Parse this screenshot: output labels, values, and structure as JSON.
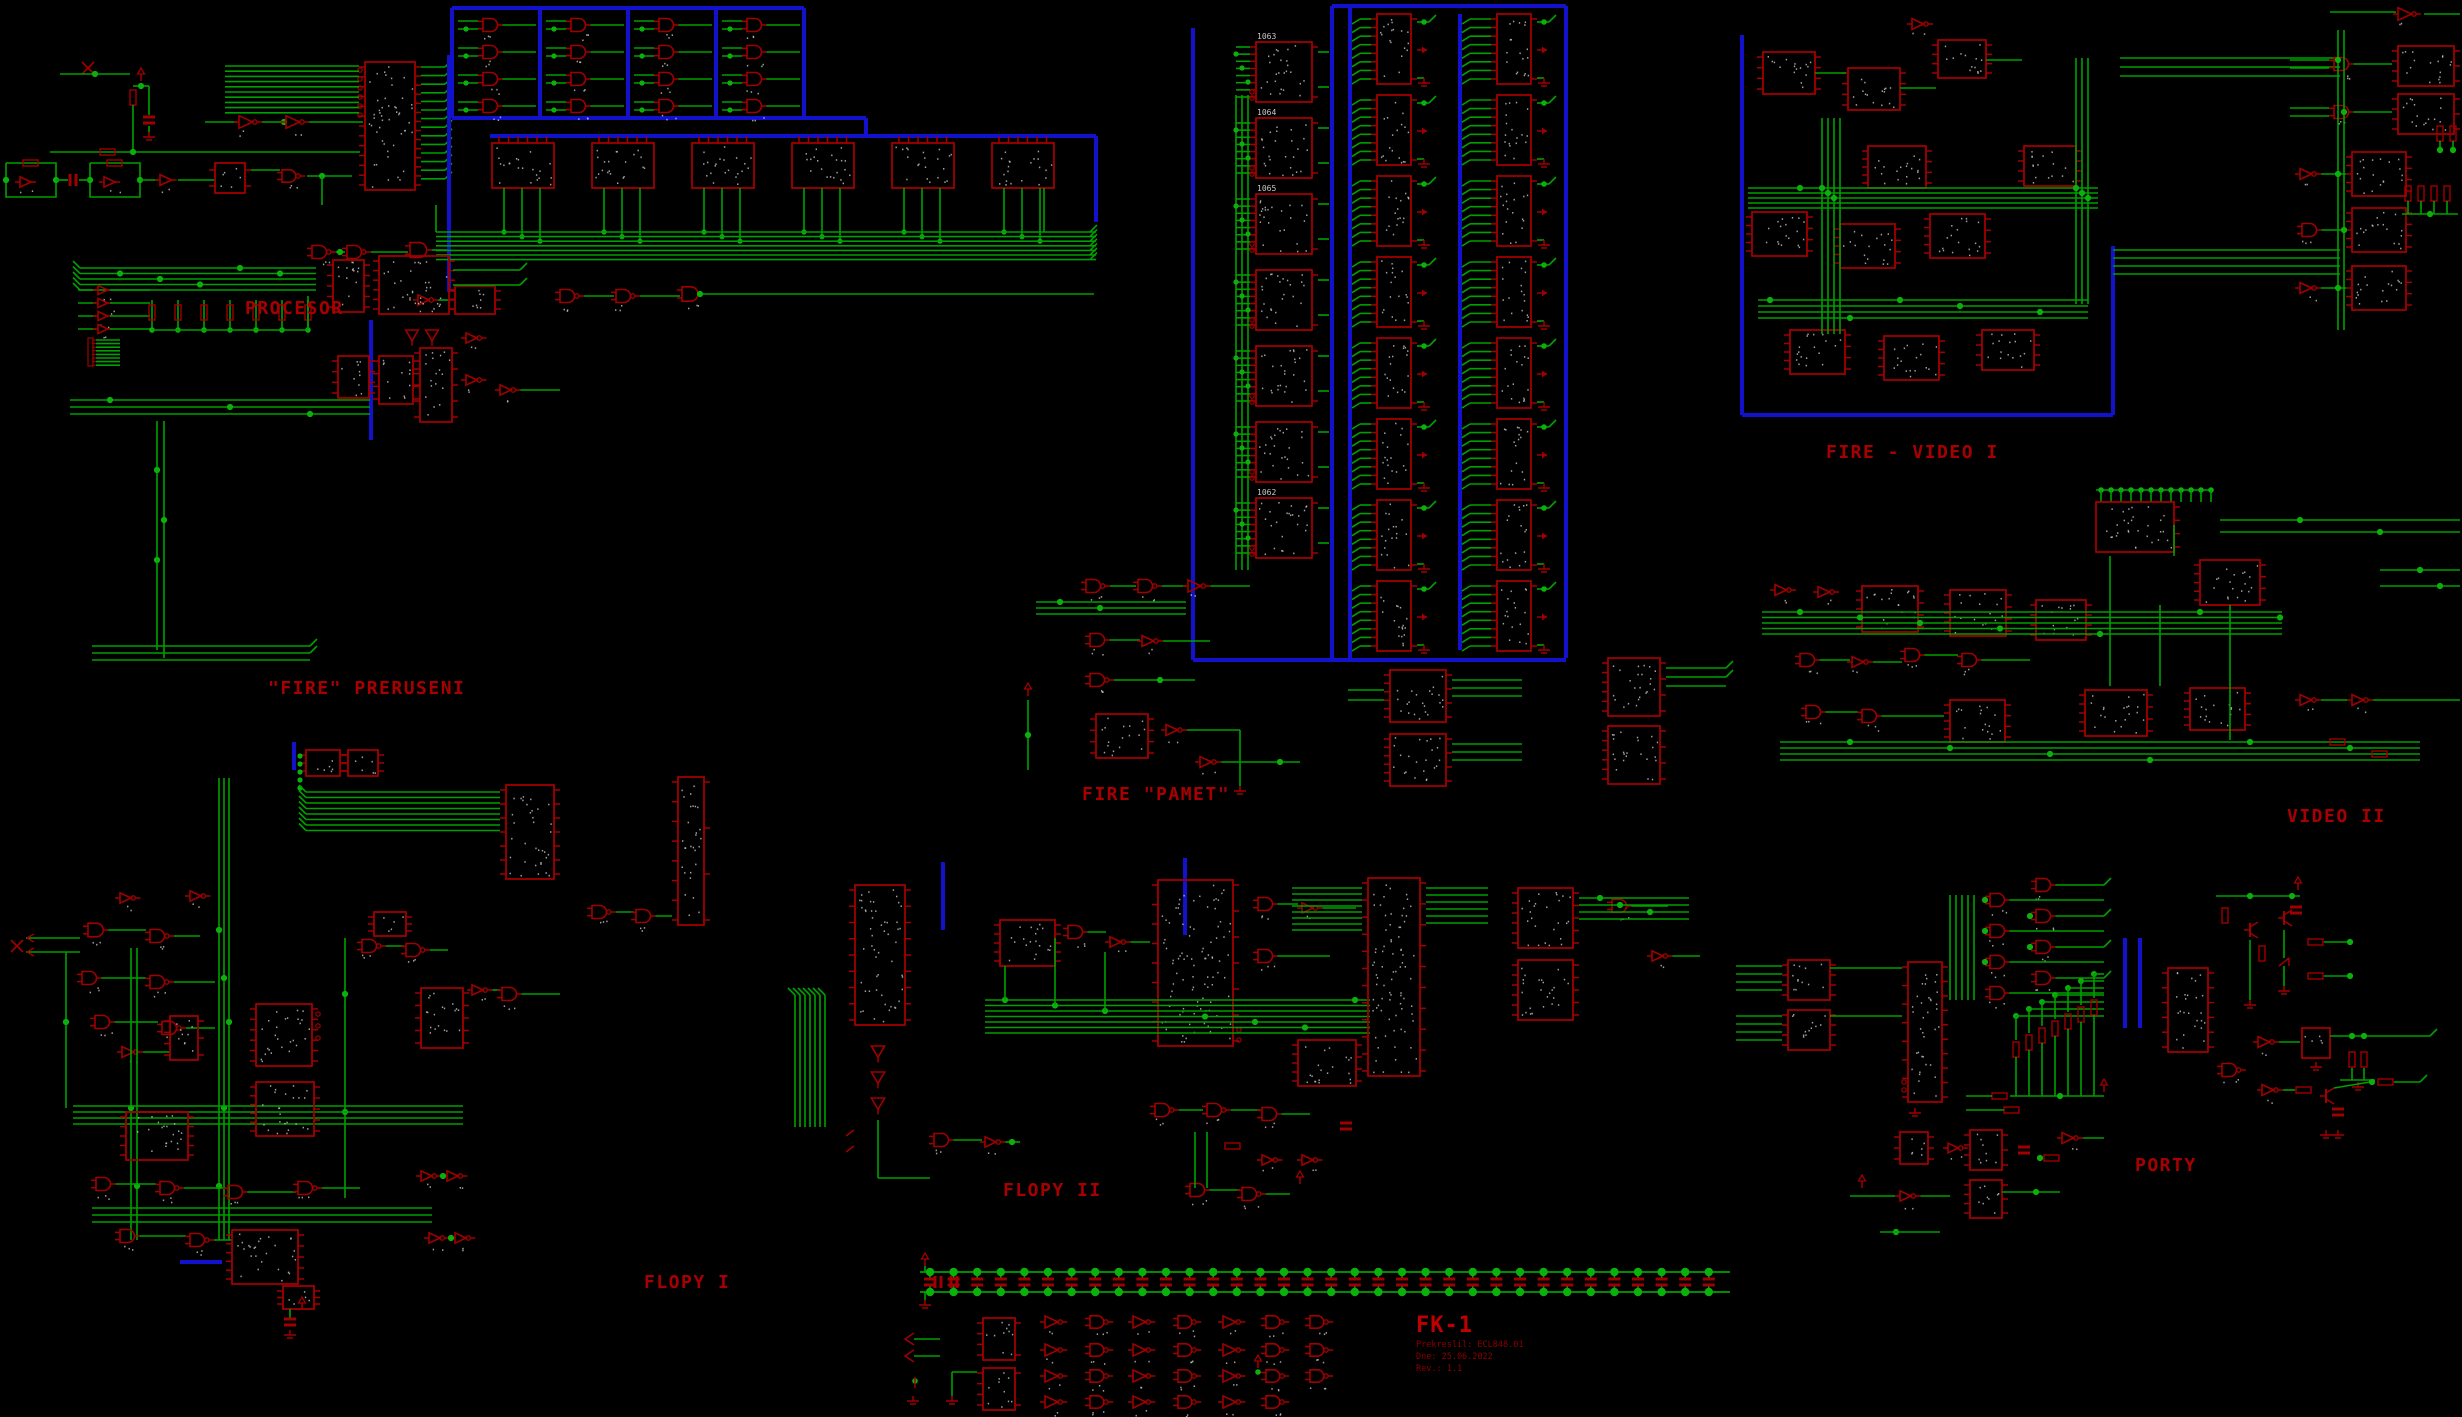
{
  "app": {
    "type": "schematic-drawing",
    "background": "#000000"
  },
  "colors": {
    "background": "#000000",
    "wire": "#00A000",
    "junction": "#0CB00C",
    "component": "#A00000",
    "bus": "#1212CC",
    "pin_text": "#C8C8C8",
    "label": "#A80000",
    "title": "#C00000",
    "title_dim": "#8C0000"
  },
  "sections": {
    "procesor": {
      "label": "PROCESOR"
    },
    "fire_preruseni": {
      "label": "\"FIRE\" PRERUSENI"
    },
    "fire_pamet": {
      "label": "FIRE \"PAMET\"",
      "ic_refs": [
        "1063",
        "1064",
        "1065",
        "1062"
      ]
    },
    "fire_video_i": {
      "label": "FIRE - VIDEO I"
    },
    "video_ii": {
      "label": "VIDEO II"
    },
    "flopy_i": {
      "label": "FLOPY I"
    },
    "flopy_ii": {
      "label": "FLOPY II"
    },
    "porty": {
      "label": "PORTY"
    }
  },
  "title_block": {
    "title": "FK-1",
    "line1": "Prekreslil: ECL848.01",
    "line2": "Dne: 25.06.2022",
    "line3": "Rev.: 1.1"
  }
}
